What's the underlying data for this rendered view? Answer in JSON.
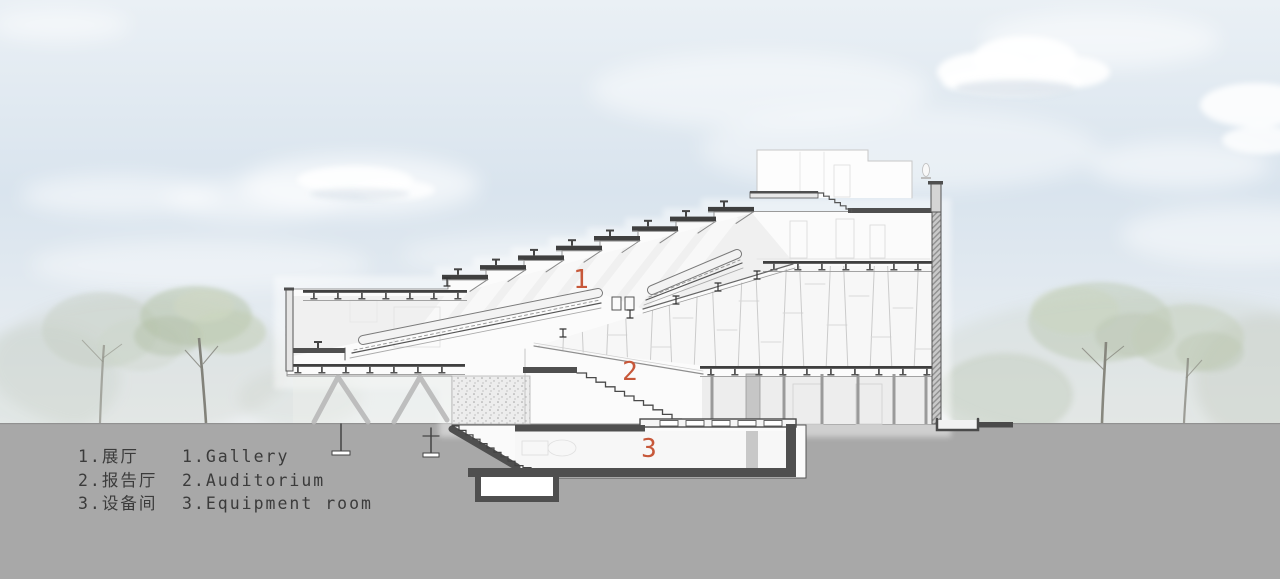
{
  "drawing": {
    "title": "building-section",
    "marker_gallery": "1",
    "marker_auditorium": "2",
    "marker_equipment": "3"
  },
  "legend": {
    "rows": [
      {
        "zh": "1.展厅",
        "en": "1.Gallery"
      },
      {
        "zh": "2.报告厅",
        "en": "2.Auditorium"
      },
      {
        "zh": "3.设备间",
        "en": "3.Equipment room"
      }
    ]
  },
  "colors": {
    "marker": "#c7583a",
    "ground": "#a8a8a8",
    "sky_top": "#eaf0f5",
    "sky_mid": "#d9e4ee",
    "line": "#4a4a4a",
    "poche": "#4f4f4f",
    "foliage": "#c3cdbf",
    "text": "#3b3b3b"
  }
}
